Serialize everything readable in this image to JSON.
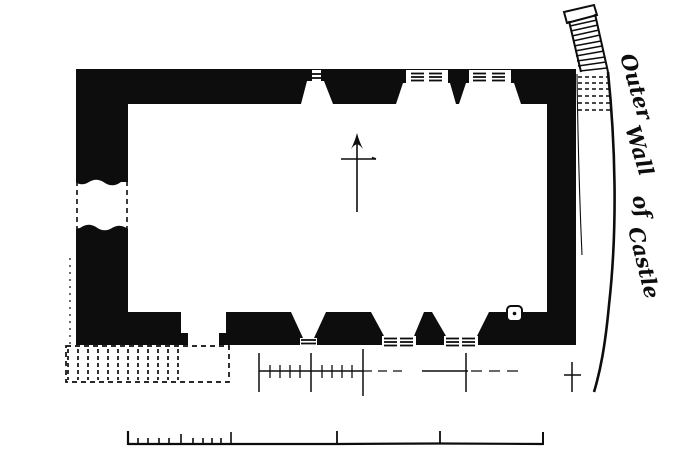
{
  "figure": {
    "type": "architectural-floor-plan",
    "annotation": {
      "full_text": "Outer Wall of Castle",
      "words": [
        "Outer",
        "Wall",
        "of",
        "Castle"
      ]
    },
    "colors": {
      "ink": "#0d0d0d",
      "paper": "#ffffff"
    },
    "symbols": {
      "north_arrow": "north-arrow",
      "scale_bar": "graphic-scale-bar",
      "dimension_line": "ticked-dimension-line",
      "wall_fill": "solid-black-poche",
      "ruin_convention": "dashed-outline"
    }
  }
}
